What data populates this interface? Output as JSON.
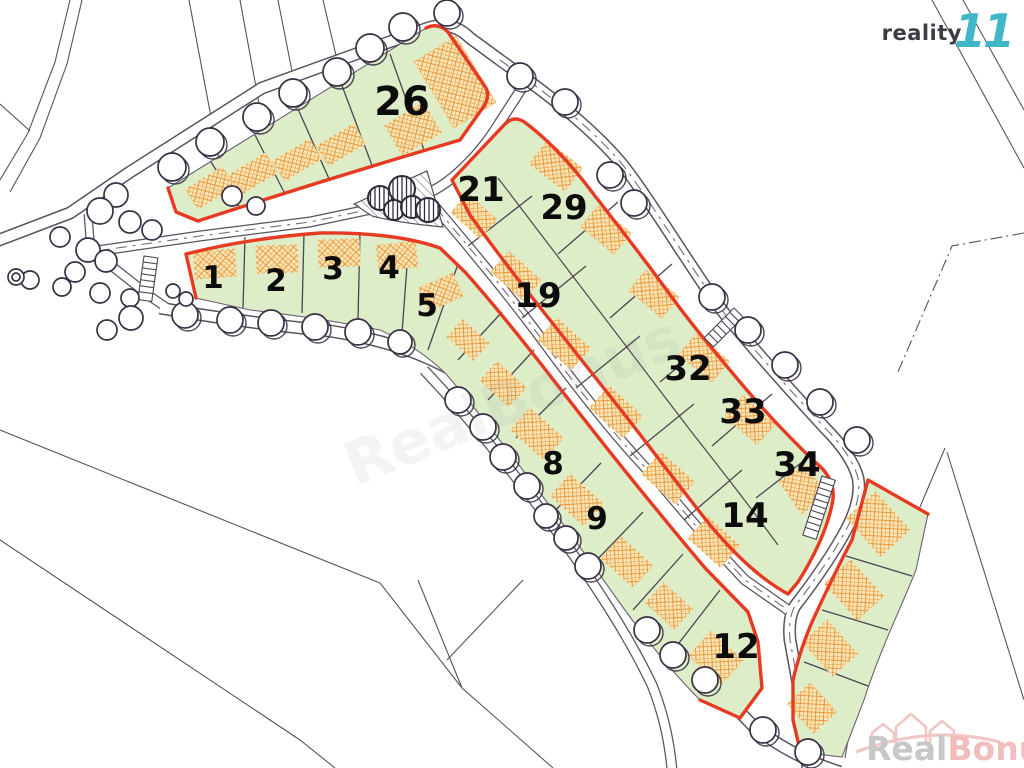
{
  "branding": {
    "agency_name": "reality",
    "agency_number": "11",
    "colors": {
      "number_teal": "#41b6c7",
      "text_gray": "#3f3b42"
    }
  },
  "watermarks": {
    "corner": {
      "part1": "Real",
      "part2": "Bonus",
      "suffix": ".cz"
    },
    "center": {
      "text": "RealBonus"
    }
  },
  "map": {
    "type": "land-plot-site-plan",
    "colors": {
      "plot_fill": "#dcedc8",
      "boundary_red": "#e73a22",
      "building_hatch_orange": "#e59a3f",
      "linework": "#5a525f"
    },
    "plots": [
      {
        "label": "26"
      },
      {
        "label": "21"
      },
      {
        "label": "29"
      },
      {
        "label": "1"
      },
      {
        "label": "2"
      },
      {
        "label": "3"
      },
      {
        "label": "4"
      },
      {
        "label": "5"
      },
      {
        "label": "19"
      },
      {
        "label": "8"
      },
      {
        "label": "9"
      },
      {
        "label": "32"
      },
      {
        "label": "33"
      },
      {
        "label": "34"
      },
      {
        "label": "14"
      },
      {
        "label": "12"
      }
    ]
  }
}
